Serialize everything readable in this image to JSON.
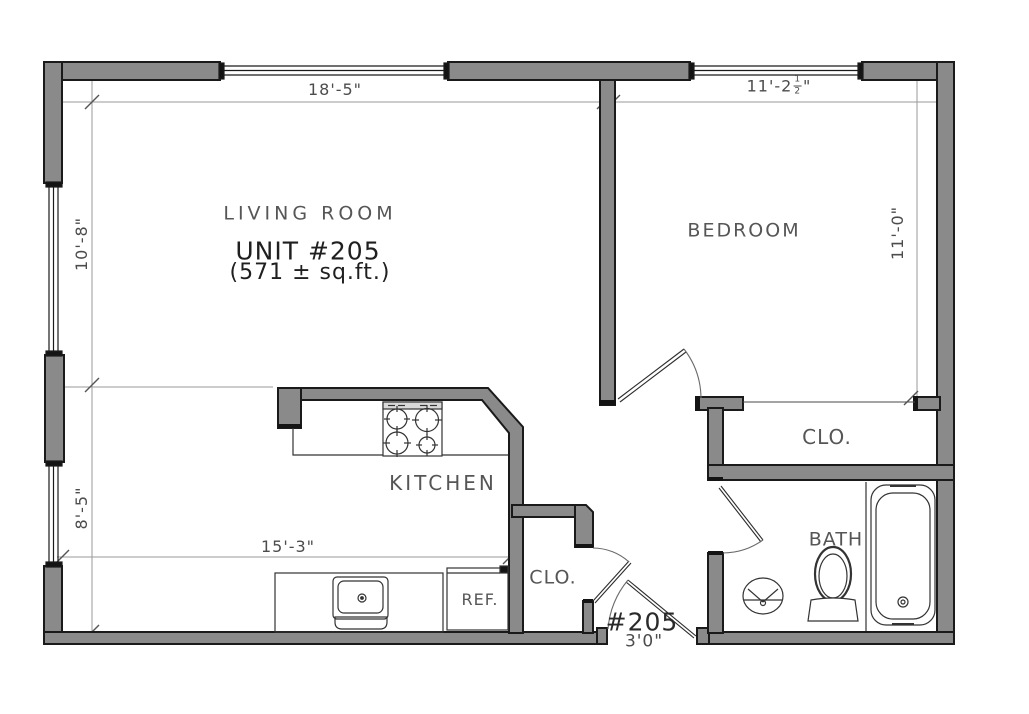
{
  "labels": {
    "living_room": "LIVING ROOM",
    "unit": "UNIT #205",
    "area": "(571 ± sq.ft.)",
    "bedroom": "BEDROOM",
    "kitchen": "KITCHEN",
    "bath": "BATH",
    "bedroom_closet": "CLO.",
    "entry_closet": "CLO.",
    "refrigerator": "REF."
  },
  "dimensions": {
    "living_width": "18'-5\"",
    "bedroom_width_prefix": "11'-2",
    "bedroom_width_frac_num": "1",
    "bedroom_width_frac_den": "2",
    "bedroom_width_suffix": "\"",
    "living_height_upper": "10'-8\"",
    "living_height_lower": "8'-5\"",
    "bedroom_height": "11'-0\"",
    "kitchen_width": "15'-3\"",
    "entry_door_unit": "#205",
    "entry_door_width": "3'0\""
  },
  "colors": {
    "bg": "#ffffff",
    "wall_fill": "#8a8a8a",
    "wall_outline": "#1a1a1a",
    "window_line": "#1a1a1a",
    "dim_line": "#9a9a9a",
    "tick": "#555555",
    "thin_line": "#5f5f5f",
    "fixture_line": "#333333"
  }
}
